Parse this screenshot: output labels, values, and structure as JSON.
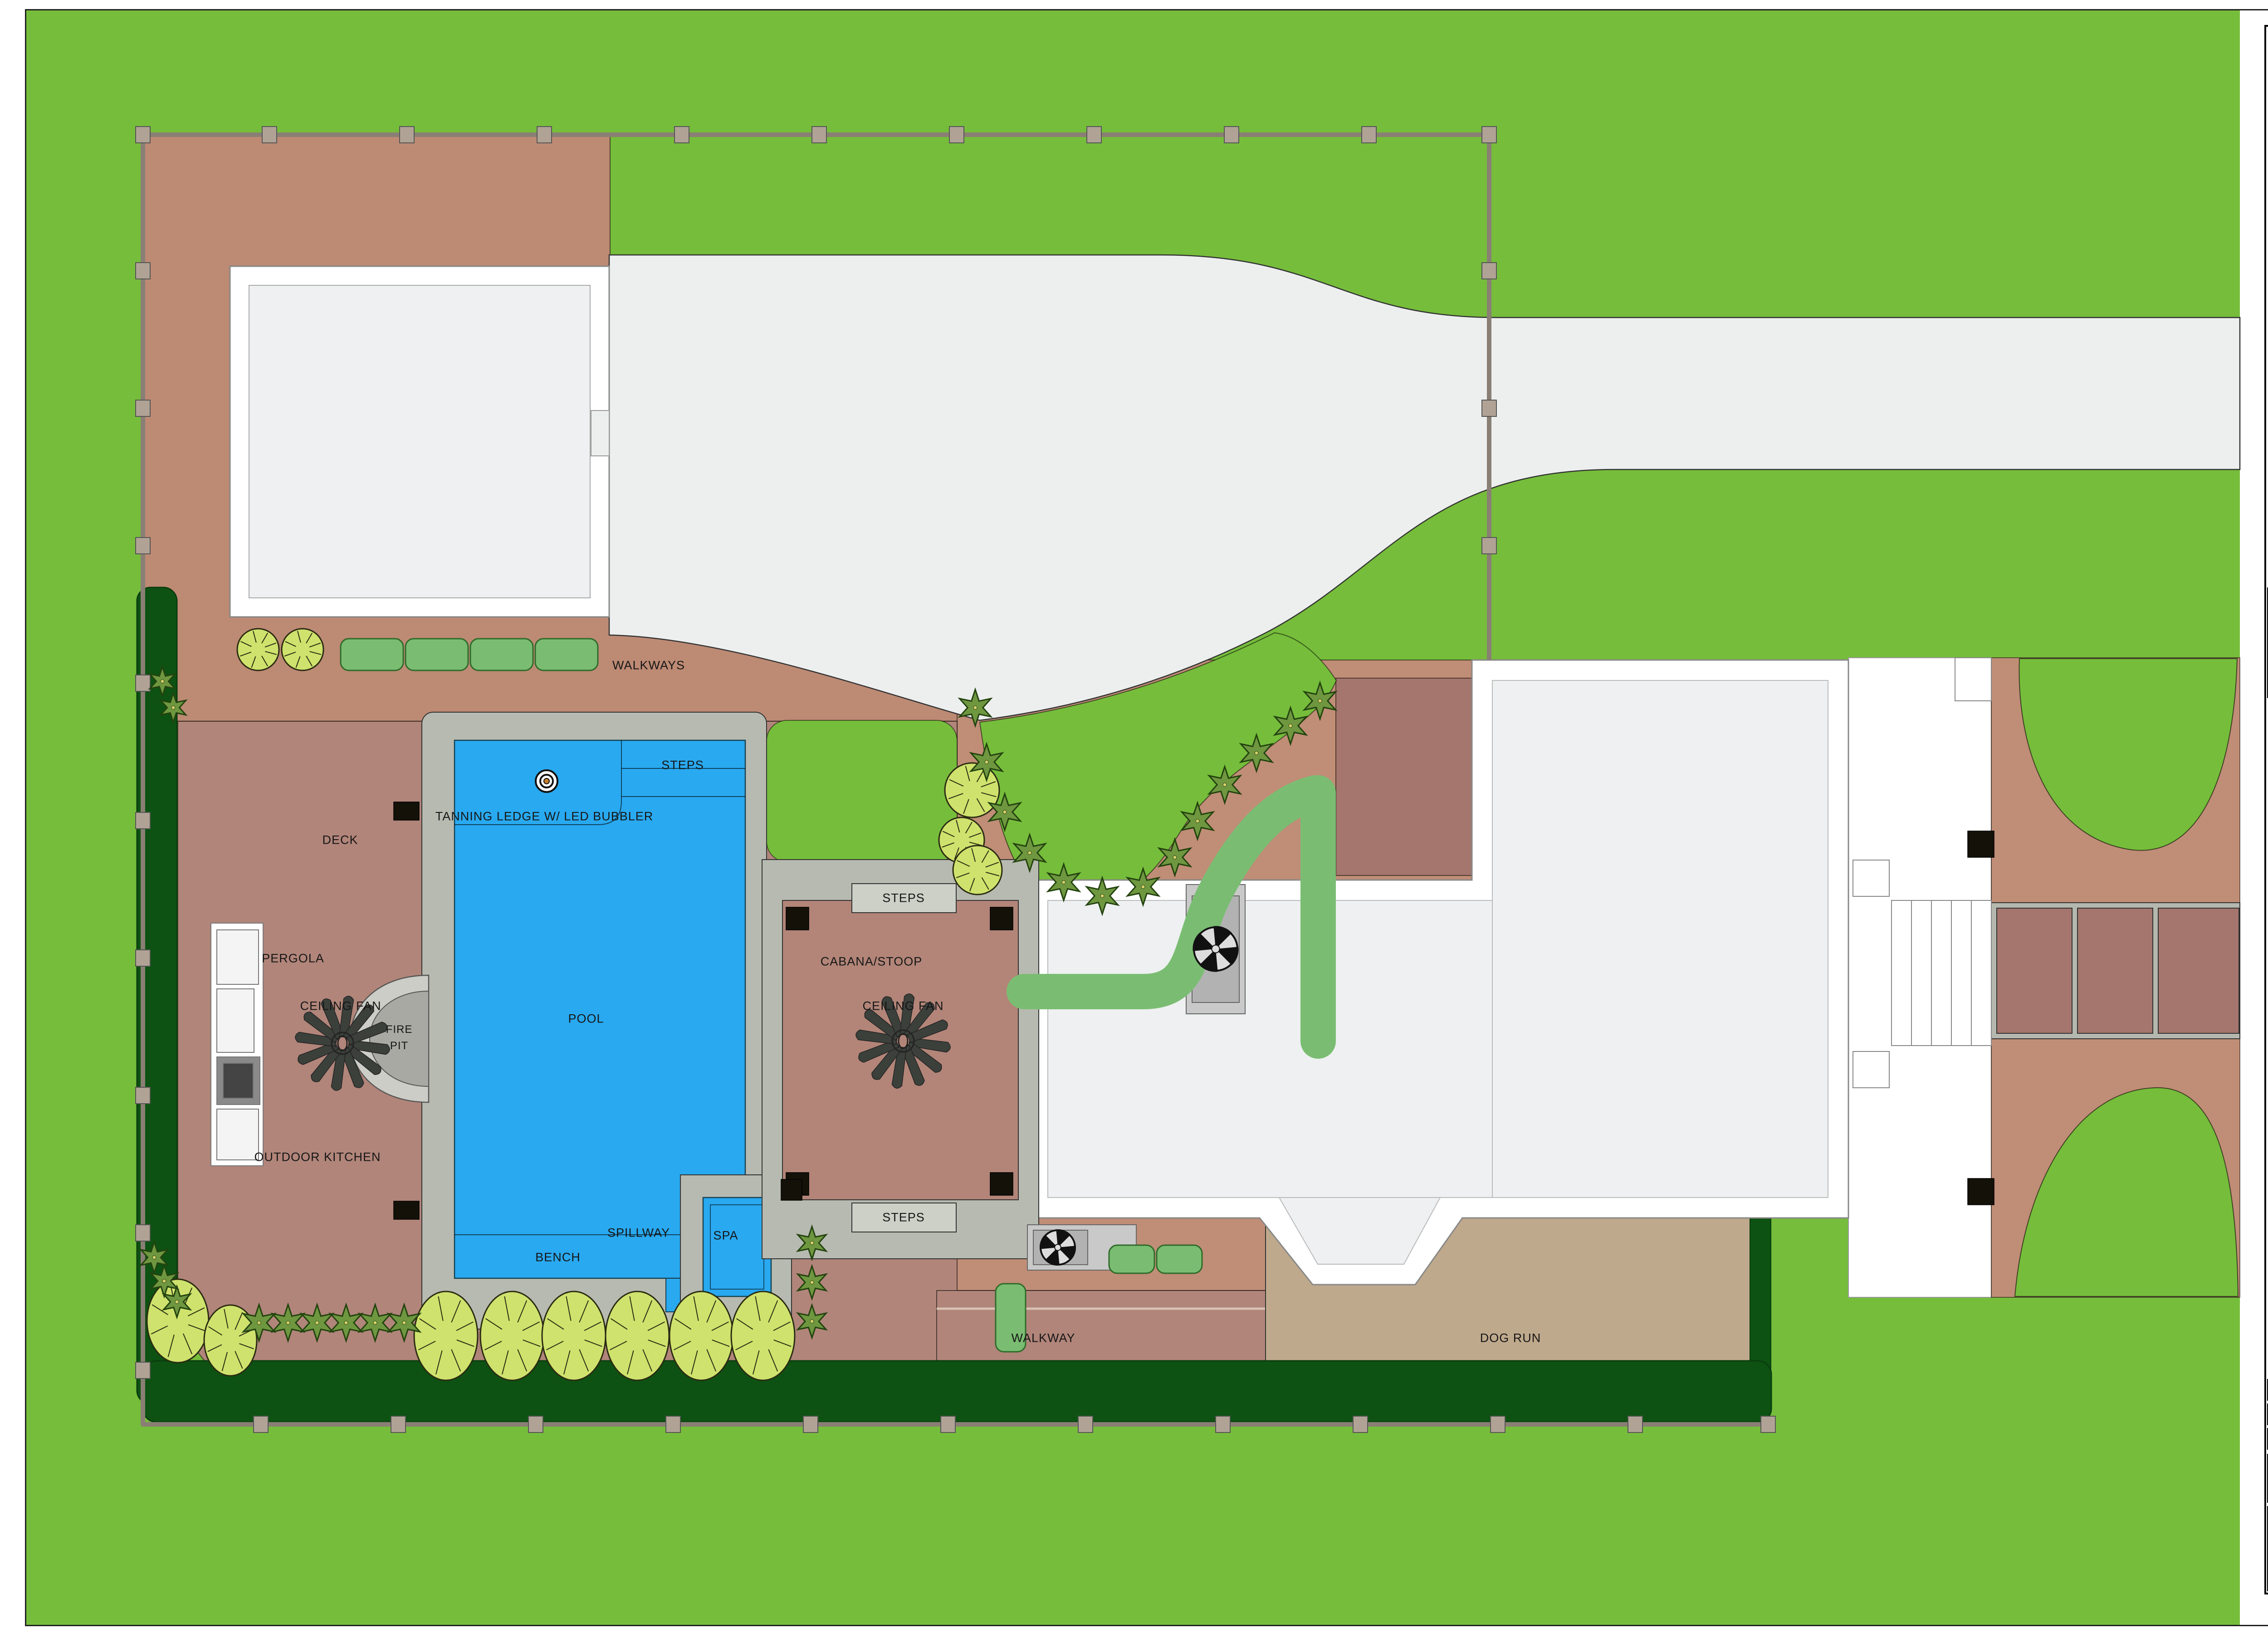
{
  "plan": {
    "labels": {
      "walkways": "WALKWAYS",
      "steps": "STEPS",
      "tanning_ledge": "TANNING LEDGE W/ LED BUBBLER",
      "deck": "DECK",
      "pergola": "PERGOLA",
      "ceiling_fan": "CEILING FAN",
      "fire_pit_line1": "FIRE",
      "fire_pit_line2": "PIT",
      "pool": "POOL",
      "outdoor_kitchen": "OUTDOOR KITCHEN",
      "cabana": "CABANA/STOOP",
      "spillway": "SPILLWAY",
      "spa": "SPA",
      "bench": "BENCH",
      "walkway": "WALKWAY",
      "dog_run": "DOG RUN"
    }
  },
  "title_block": {
    "logo": "PRATT GUYS",
    "address": "6967 PHILLIPS HWY. | JACKSONVILLE, FL 32216 | 904.737.4652 | CBC 056685 | CPC 056645",
    "revision_table": {
      "date_header": "DATE",
      "revision_header": "REVISION"
    },
    "copyright": "All of the Plans, Images and Content in this document are protected under United States copyright laws. Reproduction of the plans or images in any way is strictly prohibited.",
    "residence": "MCGOVERN/POORE RESIDENCE",
    "address_line1": "4251 Irvington Avenue",
    "address_line2": "Jacksonville, FL 32210",
    "project_no_label": "PROJECT NO.",
    "project_no": "23019",
    "date_label": "DATE:",
    "date": "06/07/2024",
    "designer_label": "DESIGNER:",
    "designer": "CHRIS EITEL",
    "sheet_title": "PROJECT OVERVIEW",
    "sheet_number": "A-4"
  },
  "colors": {
    "grass": "#76bd3b",
    "paver_light": "#bd8a74",
    "paver_bed": "#c08d76",
    "deck": "#b1857a",
    "paver_dark": "#a5766d",
    "driveway": "#edefee",
    "pool_water": "#29a9f0",
    "coping_gray": "#b7bab0",
    "dog_run_tan": "#bfa98c",
    "hedge_dark": "#0d5212",
    "hedge_light": "#7abd72",
    "tree_light": "#cfe26d",
    "shrub_olive": "#6f9740",
    "house_floor": "#eef0f1"
  }
}
